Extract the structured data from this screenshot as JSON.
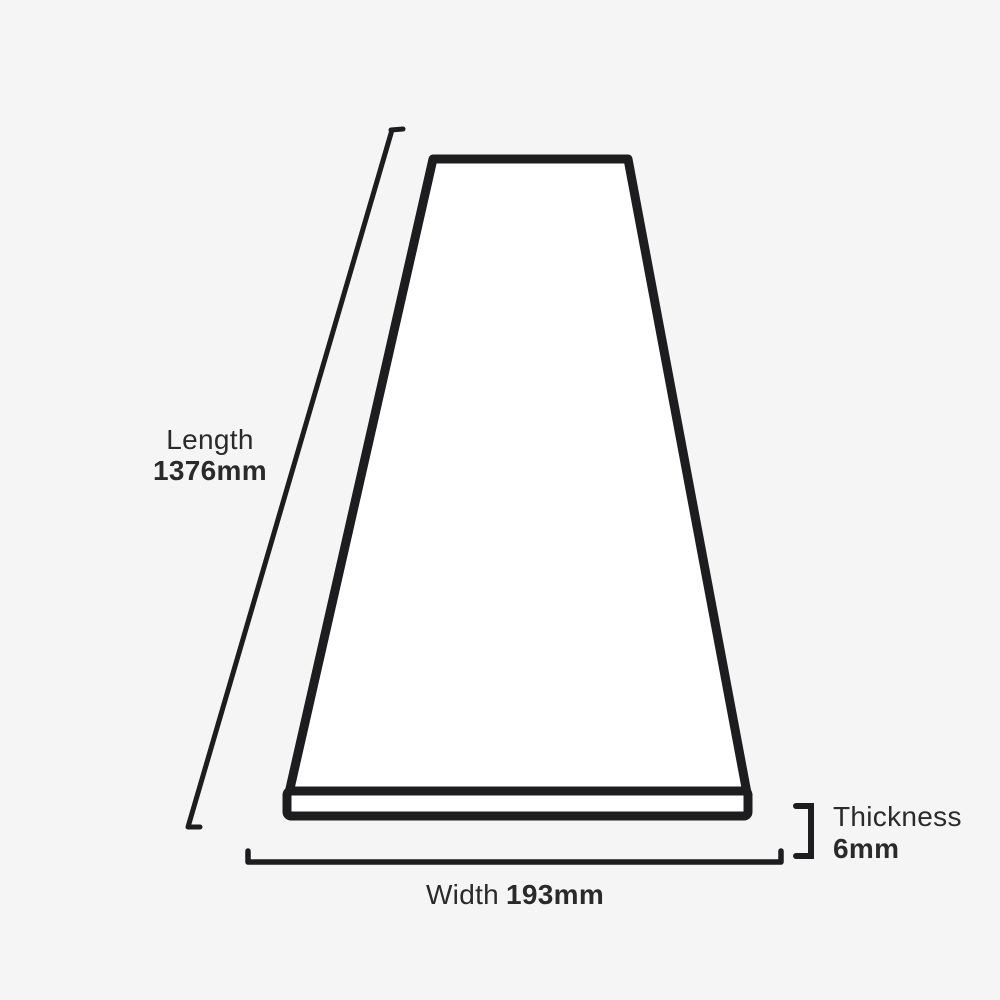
{
  "page": {
    "background_color": "#f5f5f5",
    "outline_color": "#1d1d1f",
    "text_color": "#2a2a2a"
  },
  "dimensions": {
    "length": {
      "label": "Length",
      "value": "1376mm"
    },
    "width": {
      "label": "Width",
      "value": "193mm"
    },
    "thickness": {
      "label": "Thickness",
      "value": "6mm"
    }
  }
}
